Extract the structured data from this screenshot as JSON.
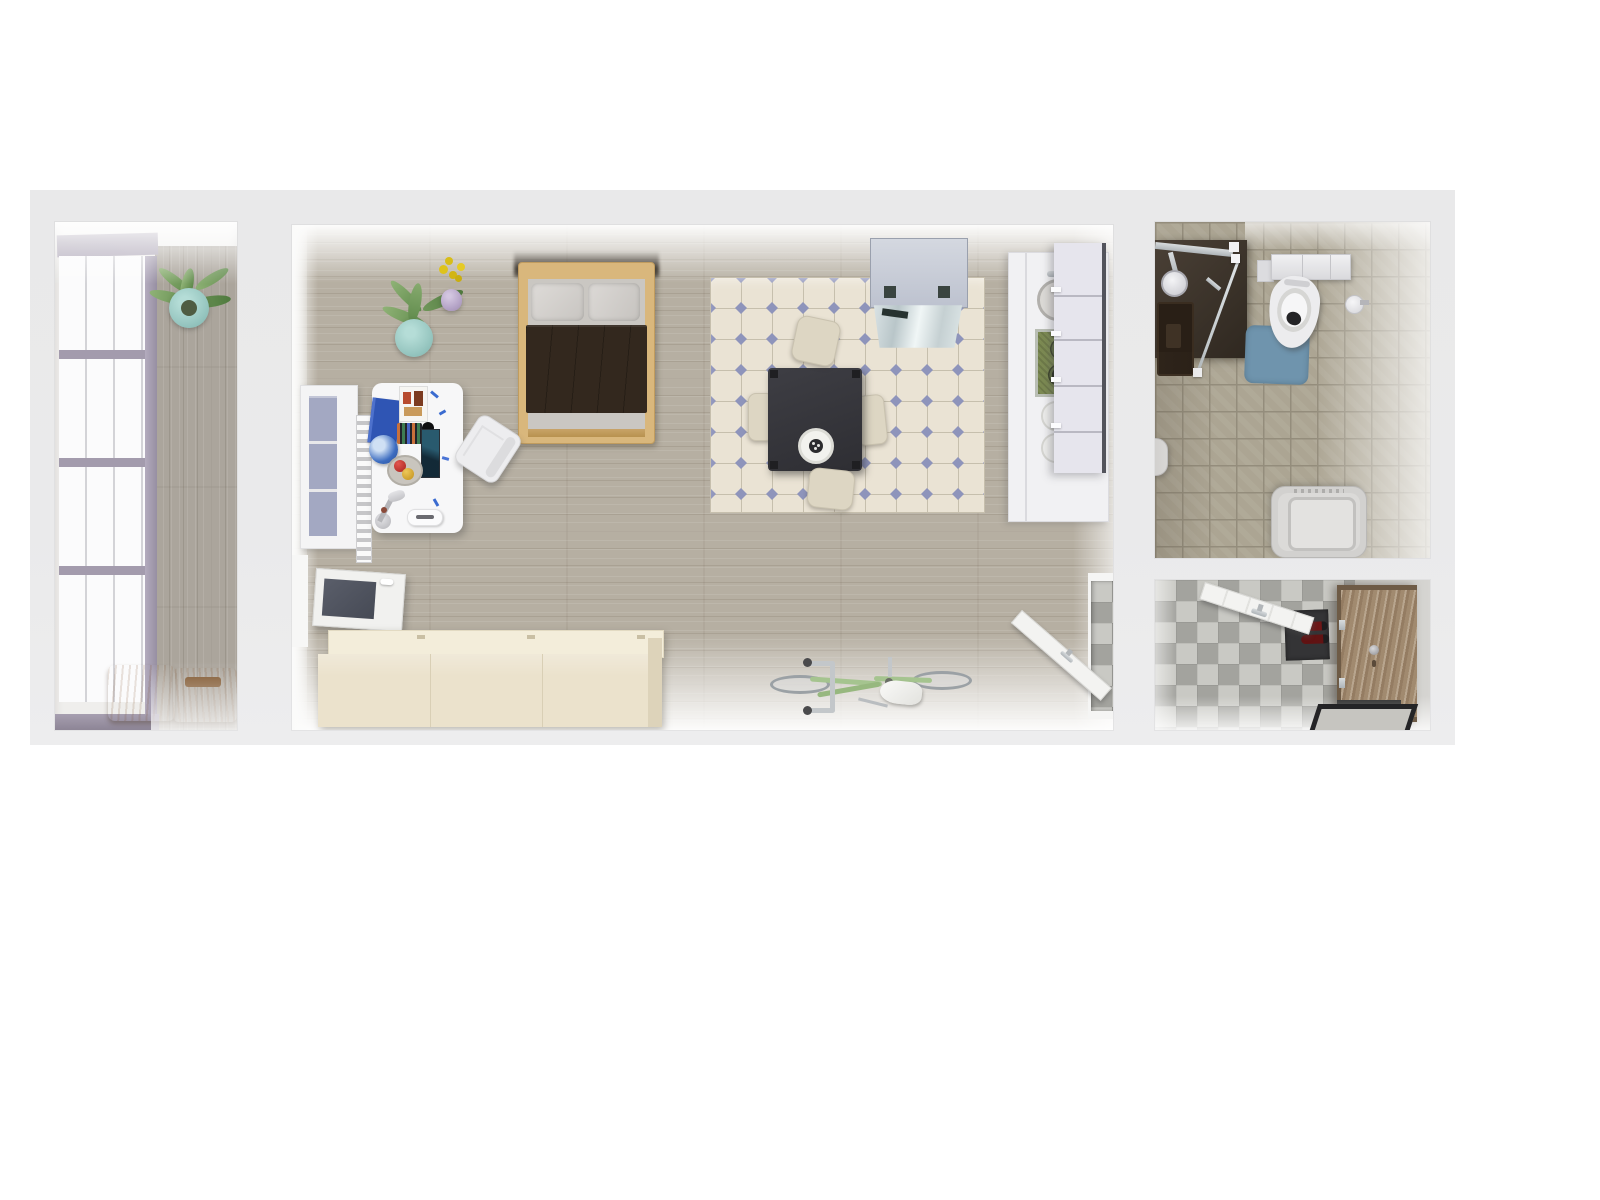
{
  "scene": {
    "title": "Top-down 3D rendering of a studio apartment floor plan",
    "rooms": [
      {
        "name": "balcony",
        "items": [
          "window-wall",
          "potted-plant",
          "wooden-step-stools",
          "plank-floor"
        ]
      },
      {
        "name": "main-room",
        "items": [
          "double-bed",
          "desk-with-accessories",
          "desk-chair",
          "window-with-radiator",
          "open-balcony-door",
          "potted-plant",
          "flower-vase",
          "kitchen-tile-rug",
          "dining-table-with-plate",
          "four-dining-chairs",
          "range-hood",
          "kitchen-counter-with-sink-and-hob",
          "wall-cabinets",
          "sideboard",
          "bicycle",
          "open-hallway-door"
        ]
      },
      {
        "name": "bathroom",
        "items": [
          "shower-with-glass-screen",
          "shower-mat",
          "toilet",
          "blue-bath-mat",
          "toilet-paper-holder",
          "laundry-bin",
          "door-handle"
        ]
      },
      {
        "name": "hallway",
        "items": [
          "checkerboard-floor",
          "entry-door",
          "open-interior-door",
          "doormat-with-red-shoes",
          "framed-floor-mat"
        ]
      }
    ]
  },
  "palette": {
    "page_bg": "#ffffff",
    "wall_band": "#e9e9ea",
    "lavender_frame": "#a29aad",
    "window_glass": "#fbfbfc",
    "office_glass": "#a3a8c2",
    "balcony_wood": "#aba59c",
    "room_wood": "#b6afa2",
    "rug_base": "#eae3d4",
    "rug_grout": "#c6bfad",
    "rug_diamond": "#8e94bb",
    "table_dark": "#36363b",
    "chair_cream": "#ddd6c3",
    "hood_gray": "#c7cbd5",
    "counter_white": "#f1f1f3",
    "cabinet_lavender": "#e6e5ed",
    "stove_green": "#7c8a52",
    "accent_red": "#c2303a",
    "bed_wood": "#d9b77c",
    "blanket_brown": "#33281e",
    "pillow_gray": "#d6d3d0",
    "desk_white": "#f7f7f8",
    "book_blue": "#2f55b4",
    "sideboard_cream": "#ebe2cc",
    "bike_green": "#a5c48f",
    "bath_tile": "#aca593",
    "bath_grout": "#948d7c",
    "shower_brown": "#2f2820",
    "mat_blue": "#6f94ad",
    "fixture_white": "#ececee",
    "washer_gray": "#d2d1cf",
    "checker_dark": "#a3a39e",
    "checker_light": "#c9c9c4",
    "entry_door_brown": "#a08a70",
    "mat_dark": "#343436",
    "shoe_red": "#6e1717",
    "door_white": "#f3f3f1",
    "plant_green": "#79a263",
    "pot_teal": "#9ccac4",
    "vase_purple": "#b6a5c8",
    "flower_yellow": "#dec31c",
    "stool_wood": "#c28349"
  }
}
